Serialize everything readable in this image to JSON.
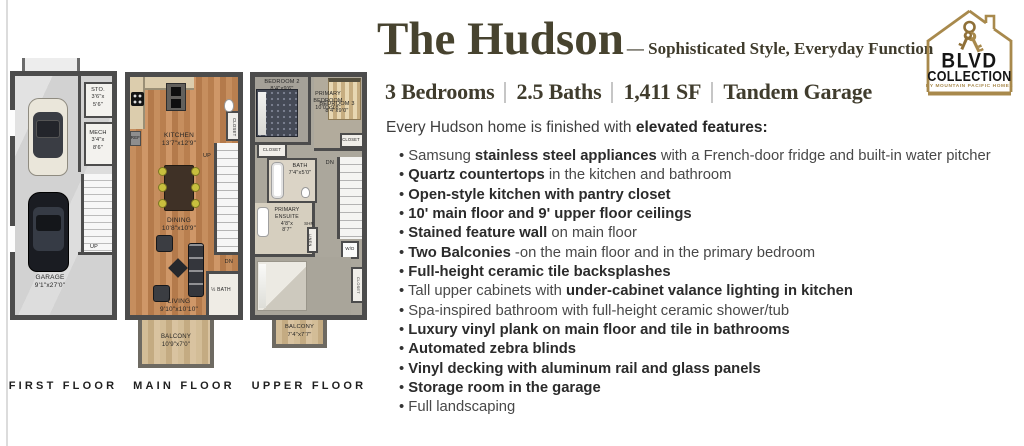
{
  "colors": {
    "gold_accent": "#a8894c",
    "heading_text": "#47432f",
    "body_text": "#484848",
    "body_bold_text": "#2b2b2b",
    "plan_wall": "#4c4c4c"
  },
  "header": {
    "title": "The Hudson",
    "tagline": "— Sophisticated Style, Everyday Function",
    "specs": [
      "3 Bedrooms",
      "2.5 Baths",
      "1,411 SF",
      "Tandem Garage"
    ],
    "intro_regular": "Every Hudson home is finished with ",
    "intro_bold": "elevated features:"
  },
  "features": [
    [
      {
        "t": "Samsung ",
        "b": false
      },
      {
        "t": "stainless steel appliances",
        "b": true
      },
      {
        "t": " with a French-door fridge and built-in water pitcher",
        "b": false
      }
    ],
    [
      {
        "t": "Quartz countertops",
        "b": true
      },
      {
        "t": " in the kitchen and bathroom",
        "b": false
      }
    ],
    [
      {
        "t": "Open-style kitchen with pantry closet",
        "b": true
      }
    ],
    [
      {
        "t": "10' main floor and 9' upper floor ceilings",
        "b": true
      }
    ],
    [
      {
        "t": "Stained feature wall",
        "b": true
      },
      {
        "t": " on main floor",
        "b": false
      }
    ],
    [
      {
        "t": "Two Balconies",
        "b": true
      },
      {
        "t": " -on the main floor and in the primary bedroom",
        "b": false
      }
    ],
    [
      {
        "t": "Full-height ceramic tile backsplashes",
        "b": true
      }
    ],
    [
      {
        "t": "Tall upper cabinets with ",
        "b": false
      },
      {
        "t": "under-cabinet valance lighting in kitchen",
        "b": true
      }
    ],
    [
      {
        "t": "Spa-inspired bathroom with full-height ceramic shower/tub",
        "b": false
      }
    ],
    [
      {
        "t": "Luxury vinyl plank on main floor and tile in bathrooms",
        "b": true
      }
    ],
    [
      {
        "t": "Automated zebra blinds",
        "b": true
      }
    ],
    [
      {
        "t": "Vinyl decking with aluminum rail and glass panels",
        "b": true
      }
    ],
    [
      {
        "t": "Storage room in the garage",
        "b": true
      }
    ],
    [
      {
        "t": "Full landscaping",
        "b": false
      }
    ]
  ],
  "logo": {
    "line1": "BLVD",
    "line2": "COLLECTION",
    "byline": "BY MOUNTAIN PACIFIC HOMES"
  },
  "plans": {
    "first": {
      "caption": "FIRST FLOOR",
      "labels": {
        "sto": "STO.\n3'6\"x\n5'6\"",
        "mech": "MECH\n3'4\"x\n8'6\"",
        "up": "UP",
        "garage": "GARAGE\n9'1\"x27'0\""
      }
    },
    "main": {
      "caption": "MAIN FLOOR",
      "labels": {
        "kitchen": "KITCHEN\n13'7\"x12'9\"",
        "closet": "CLOSET",
        "ref": "REF",
        "up": "UP",
        "dining": "DINING\n10'8\"x10'9\"",
        "dn": "DN",
        "living": "LIVING\n9'10\"x10'10\"",
        "half_bath": "½ BATH",
        "balcony": "BALCONY\n10'9\"x7'0\""
      }
    },
    "upper": {
      "caption": "UPPER FLOOR",
      "labels": {
        "bedroom2": "BEDROOM 2\n8'4\"x9'6\"",
        "bedroom3": "BEDROOM 3\n8'4\"x9'0\"",
        "closet2": "CLOSET",
        "closet3": "CLOSET",
        "bath": "BATH\n7'4\"x5'0\"",
        "ensuite": "PRIMARY\nENSUITE\n4'8\"x\n8'7\"",
        "shr": "SHR",
        "linen": "LINEN",
        "dn": "DN",
        "wd": "W/D",
        "primary": "PRIMARY\nBEDROOM\n10'0\"x9'8\"",
        "closet_primary": "CLOSET",
        "balcony": "BALCONY\n7'4\"x7'7\""
      }
    }
  }
}
